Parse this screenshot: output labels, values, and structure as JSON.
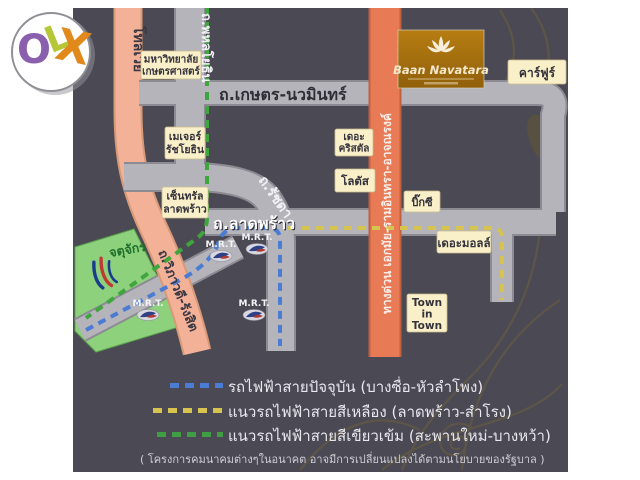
{
  "brand": {
    "o": "O",
    "l": "L",
    "x": "X"
  },
  "badge": {
    "name": "Baan Navatara"
  },
  "roads": {
    "tollway": "โทลเวย์",
    "phahonyothin": "ถ.พหลโยธิน",
    "kaset_nawamin": "ถ.เกษตร-นวมินทร์",
    "ratchada": "ถ.รัชดา",
    "ladprao": "ถ.ลาดพร้าว",
    "vibhavadi_rangsit": "ถ.วิภาวดี-รังสิต",
    "expressway": "ทางด่วน เอกมัย-รามอินทรา-อาจณรงค์"
  },
  "places": {
    "kasetsart_university": {
      "line1": "มหาวิทยาลัย",
      "line2": "เกษตรศาสตร์"
    },
    "major_ratchayothin": {
      "line1": "เมเจอร์",
      "line2": "รัชโยธิน"
    },
    "central_ladprao": {
      "line1": "เซ็นทรัล",
      "line2": "ลาดพร้าว"
    },
    "the_crystal": {
      "line1": "เดอะ",
      "line2": "คริสตัล"
    },
    "lotus": "โลตัส",
    "big_c": "บิ๊กซี",
    "the_mall": "เดอะมอลล์",
    "town_in_town": {
      "line1": "Town",
      "line2": "in",
      "line3": "Town"
    },
    "carrefour": "คาร์ฟูร์",
    "chatuchak_park": "จตุจักร"
  },
  "stations": {
    "mrt_label": "M.R.T."
  },
  "legend": {
    "rows": [
      {
        "label": "รถไฟฟ้าสายปัจจุบัน (บางซื่อ-หัวลำโพง)",
        "dash_color": "#4a7cd4"
      },
      {
        "label": "แนวรถไฟฟ้าสายสีเหลือง (ลาดพร้าว-สำโรง)",
        "dash_color": "#d6c44e"
      },
      {
        "label": "แนวรถไฟฟ้าสายสีเขียวเข้ม (สะพานใหม่-บางหว้า)",
        "dash_color": "#3f9e44"
      }
    ],
    "note": "( โครงการคมนาคมต่างๆในอนาคต อาจมีการเปลี่ยนแปลงได้ตามนโยบายของรัฐบาล )"
  },
  "colors": {
    "map_bg": "#4b4953",
    "road_gray": "#b5b4bb",
    "road_salmon": "#f3b198",
    "expressway_orange": "#e87a55",
    "label_box": "#f9efc9",
    "park_green": "#8ed17c",
    "line_blue": "#4a7cd4",
    "line_yellow": "#d6c44e",
    "line_green": "#3fa53f",
    "olx_o": "#8a5fae",
    "olx_l": "#b5c637",
    "olx_x": "#e2891c",
    "badge_brown": "#a96f0e"
  }
}
